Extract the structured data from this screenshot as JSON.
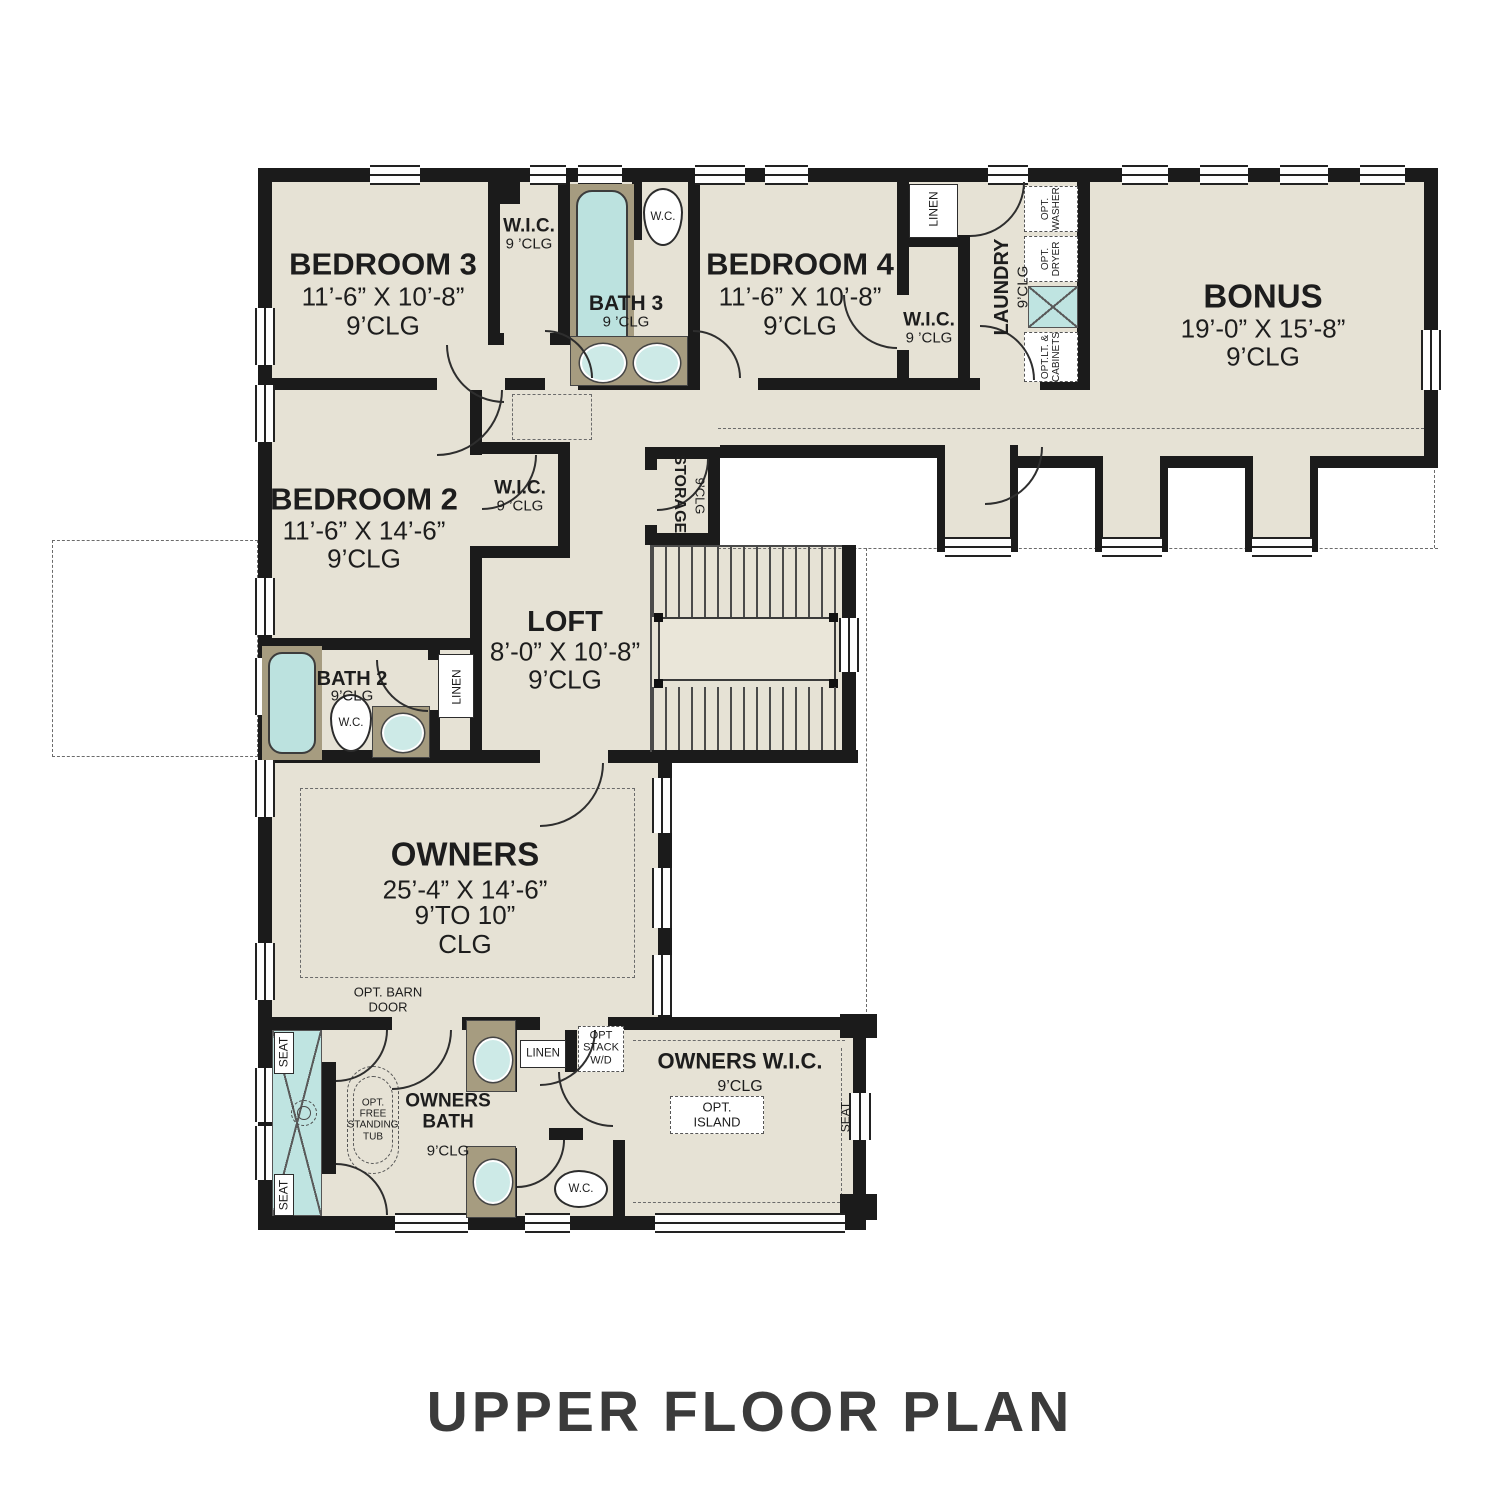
{
  "title": "UPPER FLOOR PLAN",
  "colors": {
    "floor": "#e6e2d5",
    "wall": "#1b1b1b",
    "water_fixture": "#bce2df",
    "cabinet": "#a69c80",
    "title_text": "#3b3b3b"
  },
  "rooms": {
    "bedroom3": {
      "name": "BEDROOM 3",
      "dim": "11’-6” X 10’-8”",
      "clg": "9’CLG"
    },
    "bedroom4": {
      "name": "BEDROOM 4",
      "dim": "11’-6” X 10’-8”",
      "clg": "9’CLG"
    },
    "bonus": {
      "name": "BONUS",
      "dim": "19’-0” X 15’-8”",
      "clg": "9’CLG"
    },
    "bedroom2": {
      "name": "BEDROOM 2",
      "dim": "11’-6” X 14’-6”",
      "clg": "9’CLG"
    },
    "loft": {
      "name": "LOFT",
      "dim": "8’-0” X 10’-8”",
      "clg": "9’CLG"
    },
    "owners": {
      "name": "OWNERS",
      "dim": "25’-4” X 14’-6”",
      "clg": "9’TO 10”\nCLG"
    },
    "bath3": {
      "name": "BATH 3",
      "clg": "9 ’CLG"
    },
    "bath2": {
      "name": "BATH 2",
      "clg": "9’CLG"
    },
    "owners_bath": {
      "name": "OWNERS\nBATH",
      "clg": "9’CLG"
    },
    "owners_wic": {
      "name": "OWNERS W.I.C.",
      "clg": "9’CLG"
    },
    "wic_bed3": {
      "name": "W.I.C.",
      "clg": "9 ’CLG"
    },
    "wic_bed4": {
      "name": "W.I.C.",
      "clg": "9 ’CLG"
    },
    "wic_bed2": {
      "name": "W.I.C.",
      "clg": "9 ’CLG"
    },
    "laundry": {
      "name": "LAUNDRY",
      "clg": "9’CLG"
    },
    "storage": {
      "name": "STORAGE.",
      "clg": "9’CLG"
    }
  },
  "fixtures": {
    "wc": "W.C.",
    "linen": "LINEN",
    "seat": "SEAT",
    "opt_washer": "OPT.\nWASHER",
    "opt_dryer": "OPT.\nDRYER",
    "opt_cabinets": "OPT.LT. &\nCABINETS",
    "opt_barn_door": "OPT. BARN\nDOOR",
    "opt_stack_wd": "OPT\nSTACK\nW/D",
    "opt_free_tub": "OPT.\nFREE\nSTANDING\nTUB",
    "opt_island": "OPT.\nISLAND"
  }
}
